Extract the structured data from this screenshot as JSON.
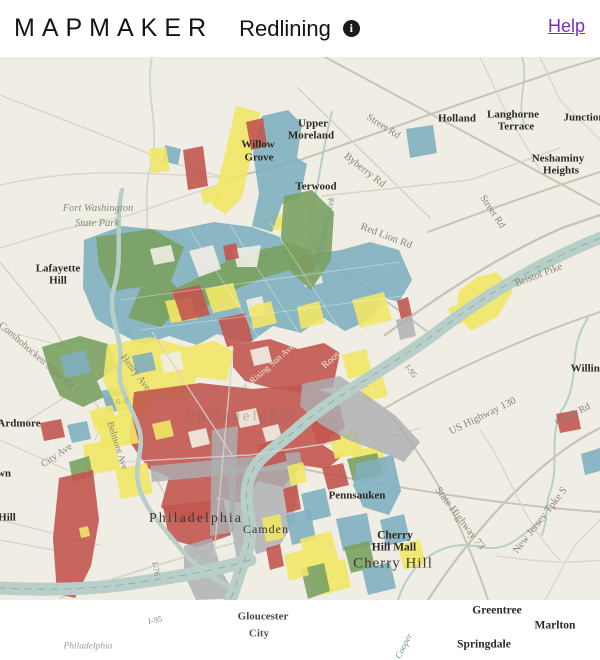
{
  "header": {
    "brand": "MAPMAKER",
    "title": "Redlining",
    "info_icon": "i",
    "help_label": "Help"
  },
  "map": {
    "colors": {
      "background": "#F0EDE4",
      "road": "#D8D3C7",
      "road_major": "#C9C4B7",
      "water": "#B8CEC8",
      "water_centerline": "#7E9C96",
      "urban_gray": "#ACAEB2",
      "grade_a_green": "#79A161",
      "grade_b_blue": "#7FAFBF",
      "grade_c_yellow": "#F1E766",
      "grade_d_red": "#C2574F",
      "place_label": "#2B2A26",
      "road_label": "#8B8577",
      "road_label_light": "#EDEBDF",
      "water_label": "#6E9B80",
      "park_label": "#7A9471",
      "help_link": "#7B2CBF"
    },
    "labels": [
      {
        "text": "Upper",
        "x": 313,
        "y": 67
      },
      {
        "text": "Moreland",
        "x": 311,
        "y": 79
      },
      {
        "text": "Willow",
        "x": 258,
        "y": 88
      },
      {
        "text": "Grove",
        "x": 259,
        "y": 101
      },
      {
        "text": "Terwood",
        "x": 316,
        "y": 130
      },
      {
        "text": "Holland",
        "x": 457,
        "y": 62
      },
      {
        "text": "Langhorne",
        "x": 513,
        "y": 58
      },
      {
        "text": "Terrace",
        "x": 516,
        "y": 70
      },
      {
        "text": "Junction",
        "x": 584,
        "y": 61
      },
      {
        "text": "Neshaminy",
        "x": 558,
        "y": 102
      },
      {
        "text": "Heights",
        "x": 561,
        "y": 114
      },
      {
        "text": "Lafayette",
        "x": 58,
        "y": 212
      },
      {
        "text": "Hill",
        "x": 58,
        "y": 224
      },
      {
        "text": "Ardmore",
        "x": 19,
        "y": 367
      },
      {
        "text": "wn",
        "x": 4,
        "y": 417
      },
      {
        "text": "Hill",
        "x": 7,
        "y": 461
      },
      {
        "text": "Pennsauken",
        "x": 357,
        "y": 439
      },
      {
        "text": "Cherry",
        "x": 395,
        "y": 479,
        "size": 11.5
      },
      {
        "text": "Hill Mall",
        "x": 394,
        "y": 491,
        "size": 11.5
      },
      {
        "text": "Greentree",
        "x": 497,
        "y": 554,
        "size": 11.5
      },
      {
        "text": "Marlton",
        "x": 555,
        "y": 569,
        "size": 11.5
      },
      {
        "text": "Springdale",
        "x": 484,
        "y": 588,
        "size": 11.5
      },
      {
        "text": "Gloucester",
        "x": 263,
        "y": 560,
        "op": 0.85
      },
      {
        "text": "City",
        "x": 259,
        "y": 577,
        "op": 0.8
      },
      {
        "text": "Willing",
        "x": 588,
        "y": 312,
        "size": 11
      },
      {
        "text": "Fort Washington",
        "x": 98,
        "y": 152,
        "kind": "park",
        "size": 10.5
      },
      {
        "text": "State Park",
        "x": 97,
        "y": 167,
        "kind": "park",
        "size": 10.5
      },
      {
        "text": "Philadelphia",
        "x": 196,
        "y": 462,
        "kind": "city",
        "size": 14,
        "ls": 2
      },
      {
        "text": "Camden",
        "x": 266,
        "y": 472,
        "kind": "city",
        "size": 12,
        "ls": 1
      },
      {
        "text": "Cherry Hill",
        "x": 393,
        "y": 507,
        "kind": "city",
        "size": 15,
        "ls": 1
      },
      {
        "text": "Philadelphia",
        "x": 242,
        "y": 360,
        "kind": "city-faded",
        "size": 15,
        "ls": 3,
        "op": 0.42
      },
      {
        "text": "Philadelphia",
        "x": 88,
        "y": 590,
        "kind": "city-small",
        "size": 9.5,
        "op": 0.8
      },
      {
        "text": "Street Rd",
        "x": 383,
        "y": 70,
        "kind": "road",
        "rot": 33,
        "size": 10
      },
      {
        "text": "Byberry Rd",
        "x": 364,
        "y": 114,
        "kind": "road",
        "rot": 38,
        "size": 10.5
      },
      {
        "text": "Red Lion Rd",
        "x": 386,
        "y": 180,
        "kind": "road",
        "rot": 21,
        "size": 10.5
      },
      {
        "text": "Street Rd",
        "x": 492,
        "y": 155,
        "kind": "road",
        "rot": 56,
        "size": 10
      },
      {
        "text": "Bristol Pike",
        "x": 539,
        "y": 219,
        "kind": "road",
        "rot": -21,
        "size": 10.5
      },
      {
        "text": "I-95",
        "x": 411,
        "y": 314,
        "kind": "road",
        "rot": 52,
        "size": 8.5
      },
      {
        "text": "Roosevelt Blvd",
        "x": 347,
        "y": 290,
        "kind": "road-light",
        "rot": -41,
        "size": 10
      },
      {
        "text": "Rising Sun Ave",
        "x": 272,
        "y": 307,
        "kind": "road-light",
        "rot": -41,
        "size": 9
      },
      {
        "text": "Roosevelt Boulevard",
        "x": 178,
        "y": 339,
        "kind": "road",
        "rot": -6,
        "size": 10.5,
        "ls": 3,
        "op": 0.5
      },
      {
        "text": "Conshohocken State Rd",
        "x": 36,
        "y": 299,
        "kind": "road",
        "rot": 41,
        "size": 10
      },
      {
        "text": "Henry Ave",
        "x": 135,
        "y": 316,
        "kind": "road",
        "rot": 53,
        "size": 10
      },
      {
        "text": "City Ave",
        "x": 57,
        "y": 399,
        "kind": "road",
        "rot": -34,
        "size": 10
      },
      {
        "text": "Belmont Ave",
        "x": 116,
        "y": 389,
        "kind": "road",
        "rot": 72,
        "size": 9.5
      },
      {
        "text": "I-76",
        "x": 156,
        "y": 512,
        "kind": "road",
        "rot": 78,
        "size": 8.5
      },
      {
        "text": "I-95",
        "x": 155,
        "y": 563,
        "kind": "road",
        "rot": -10,
        "size": 8.5
      },
      {
        "text": "US Highway 130",
        "x": 483,
        "y": 360,
        "kind": "road",
        "rot": -26,
        "size": 10.5
      },
      {
        "text": "Creek Rd",
        "x": 573,
        "y": 358,
        "kind": "road",
        "rot": -27,
        "size": 10
      },
      {
        "text": "State Highway 73",
        "x": 459,
        "y": 462,
        "kind": "road",
        "rot": 53,
        "size": 10.5
      },
      {
        "text": "New Jersey Tpke S",
        "x": 541,
        "y": 464,
        "kind": "road",
        "rot": -52,
        "size": 10.5
      },
      {
        "text": "Pennypack Creek",
        "x": 325,
        "y": 171,
        "kind": "water",
        "rot": -77,
        "size": 9
      },
      {
        "text": "Cooper",
        "x": 404,
        "y": 589,
        "kind": "water",
        "rot": -62,
        "size": 9
      }
    ]
  }
}
